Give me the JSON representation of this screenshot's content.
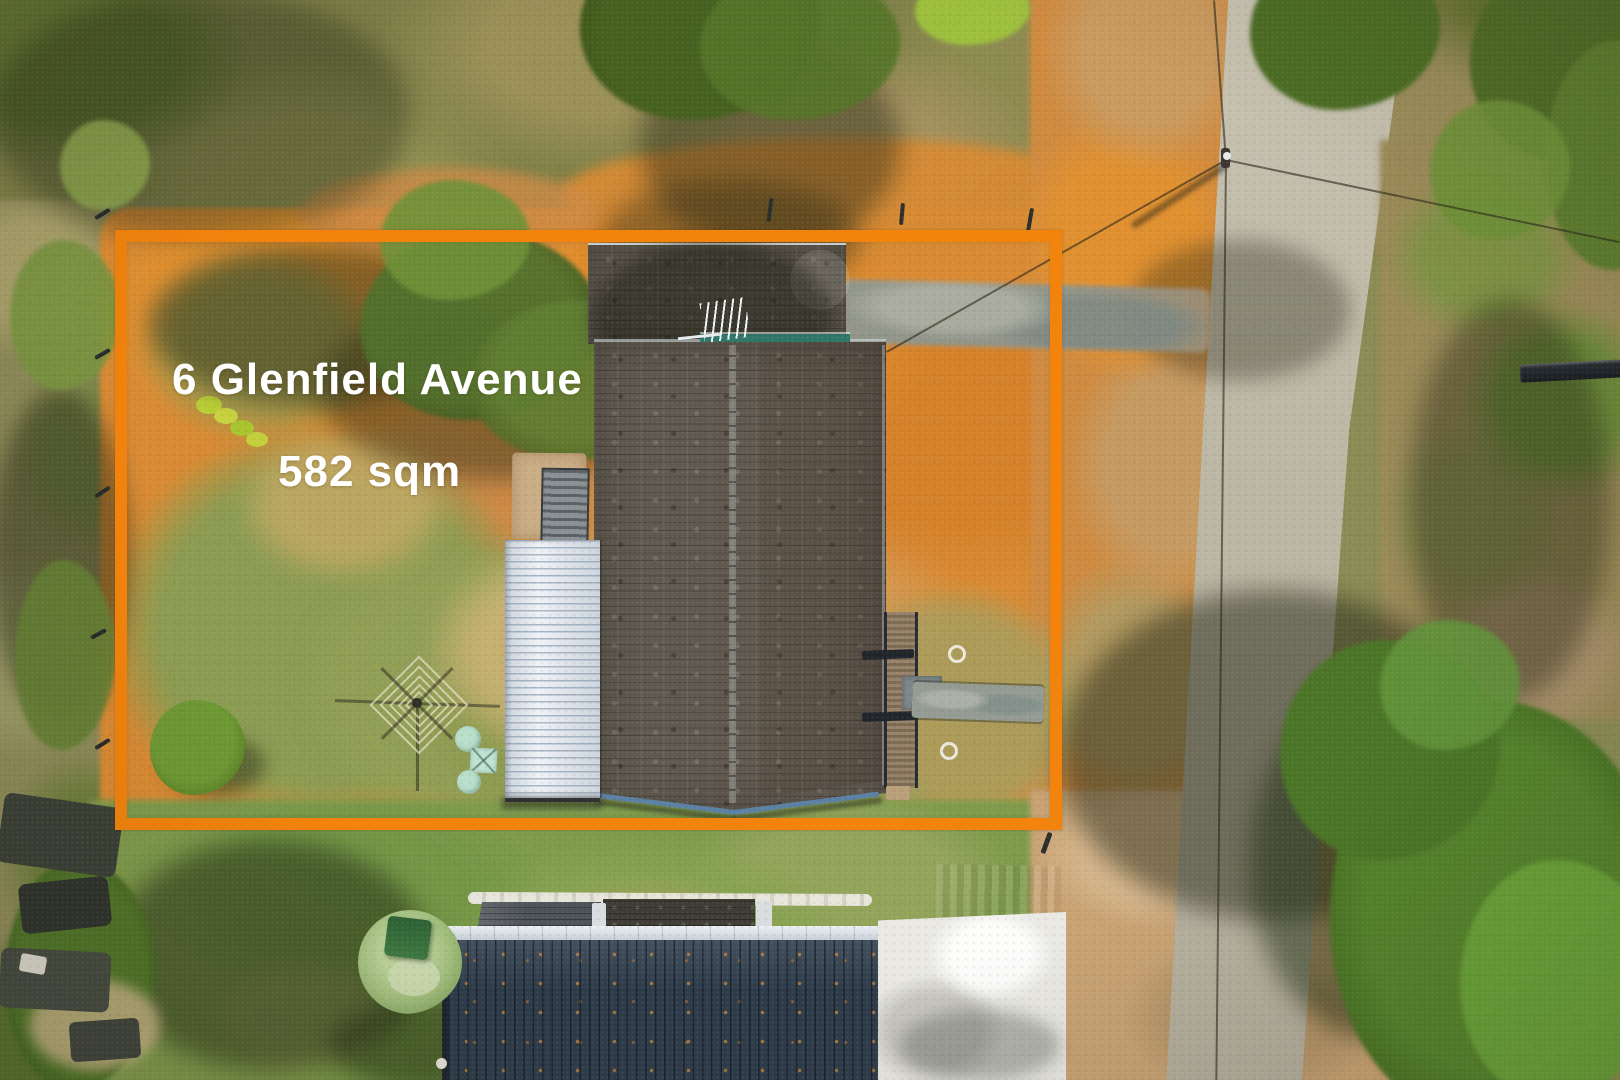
{
  "overlay": {
    "address": "6 Glenfield Avenue",
    "area": "582 sqm"
  },
  "colors": {
    "boundary_orange": "#f2830d",
    "overlay_text": "#ffffff"
  }
}
